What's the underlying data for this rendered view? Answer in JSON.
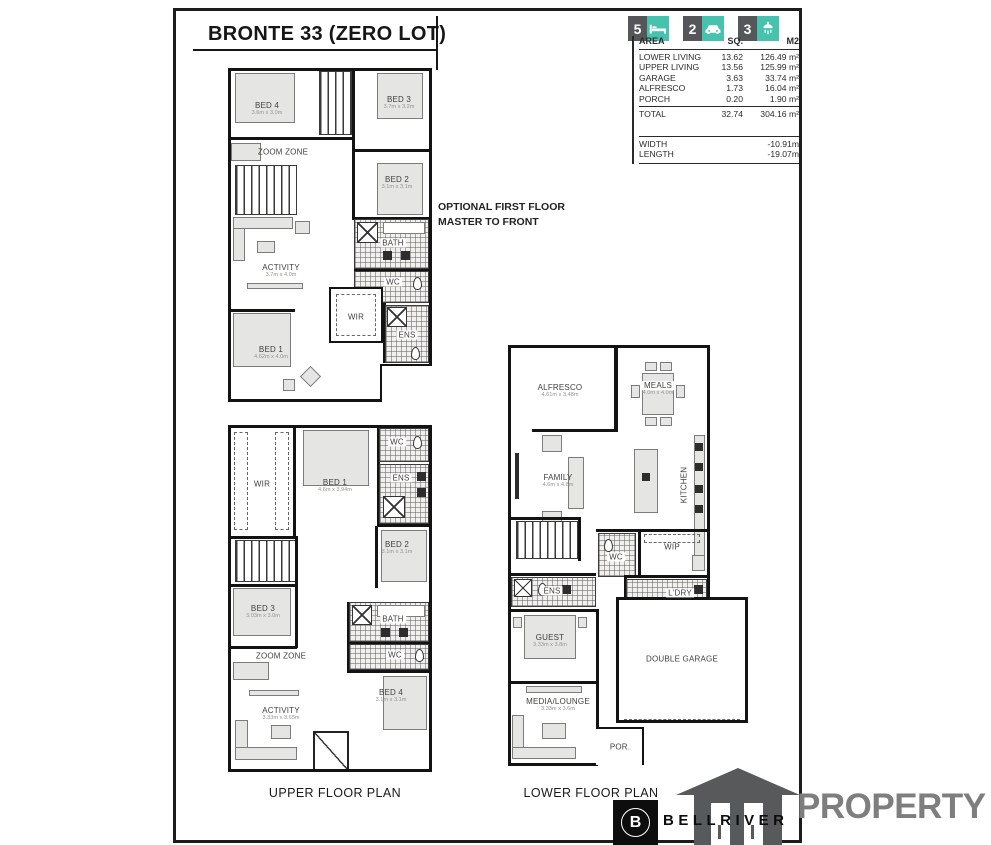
{
  "title": "BRONTE 33 (ZERO LOT)",
  "note_line1": "OPTIONAL FIRST FLOOR",
  "note_line2": "MASTER TO FRONT",
  "badges": {
    "beds": "5",
    "cars": "2",
    "baths": "3"
  },
  "area_table": {
    "col_area": "AREA",
    "col_sq": "SQ.",
    "col_m2": "M2",
    "rows": [
      {
        "name": "LOWER LIVING",
        "sq": "13.62",
        "m2": "126.49 m²"
      },
      {
        "name": "UPPER LIVING",
        "sq": "13.56",
        "m2": "125.99 m²"
      },
      {
        "name": "GARAGE",
        "sq": "3.63",
        "m2": "33.74 m²"
      },
      {
        "name": "ALFRESCO",
        "sq": "1.73",
        "m2": "16.04 m²"
      },
      {
        "name": "PORCH",
        "sq": "0.20",
        "m2": "1.90 m²"
      }
    ],
    "total": {
      "name": "TOTAL",
      "sq": "32.74",
      "m2": "304.16 m²"
    },
    "width_label": "WIDTH",
    "width_value": "-10.91m",
    "length_label": "LENGTH",
    "length_value": "-19.07m"
  },
  "plan_optional": {
    "rooms": {
      "bed4": {
        "label": "BED 4",
        "dims": "3.6m x 3.0m"
      },
      "bed3": {
        "label": "BED 3",
        "dims": "3.7m x 3.2m"
      },
      "zoom_zone": {
        "label": "ZOOM ZONE"
      },
      "bed2": {
        "label": "BED 2",
        "dims": "3.1m x 3.1m"
      },
      "bath": {
        "label": "BATH"
      },
      "wc": {
        "label": "WC"
      },
      "activity": {
        "label": "ACTIVITY",
        "dims": "3.7m x 4.0m"
      },
      "wir": {
        "label": "WIR"
      },
      "ens": {
        "label": "ENS"
      },
      "bed1": {
        "label": "BED 1",
        "dims": "4.62m x 4.0m"
      }
    }
  },
  "plan_upper": {
    "caption": "UPPER FLOOR PLAN",
    "rooms": {
      "wir": {
        "label": "WIR"
      },
      "bed1": {
        "label": "BED 1",
        "dims": "4.6m x 3.94m"
      },
      "wc_top": {
        "label": "WC"
      },
      "ens": {
        "label": "ENS"
      },
      "bed2": {
        "label": "BED 2",
        "dims": "3.1m x 3.1m"
      },
      "bed3": {
        "label": "BED 3",
        "dims": "3.03m x 3.0m"
      },
      "zoom_zone": {
        "label": "ZOOM ZONE"
      },
      "bath": {
        "label": "BATH"
      },
      "wc": {
        "label": "WC"
      },
      "bed4": {
        "label": "BED 4",
        "dims": "3.1m x 3.1m"
      },
      "activity": {
        "label": "ACTIVITY",
        "dims": "3.33m x 3.65m"
      }
    }
  },
  "plan_lower": {
    "caption": "LOWER FLOOR PLAN",
    "rooms": {
      "alfresco": {
        "label": "ALFRESCO",
        "dims": "4.61m x 3.48m"
      },
      "meals": {
        "label": "MEALS",
        "dims": "4.0m x 4.0m"
      },
      "family": {
        "label": "FAMILY",
        "dims": "4.6m x 4.8m"
      },
      "kitchen": {
        "label": "KITCHEN"
      },
      "wip": {
        "label": "WIP"
      },
      "wc": {
        "label": "WC"
      },
      "ens": {
        "label": "ENS"
      },
      "ldry": {
        "label": "L'DRY"
      },
      "guest": {
        "label": "GUEST",
        "dims": "3.33m x 3.8m"
      },
      "garage": {
        "label": "DOUBLE GARAGE"
      },
      "media": {
        "label": "MEDIA/LOUNGE",
        "dims": "3.33m x 3.6m"
      },
      "porch": {
        "label": "POR."
      }
    }
  },
  "branding": {
    "bellriver": "BELLRIVER",
    "property": "PROPERTY",
    "logo_letter": "B"
  },
  "colors": {
    "teal": "#47c2ae",
    "dark_badge": "#55565a",
    "property_gray": "#7e7e7e"
  }
}
